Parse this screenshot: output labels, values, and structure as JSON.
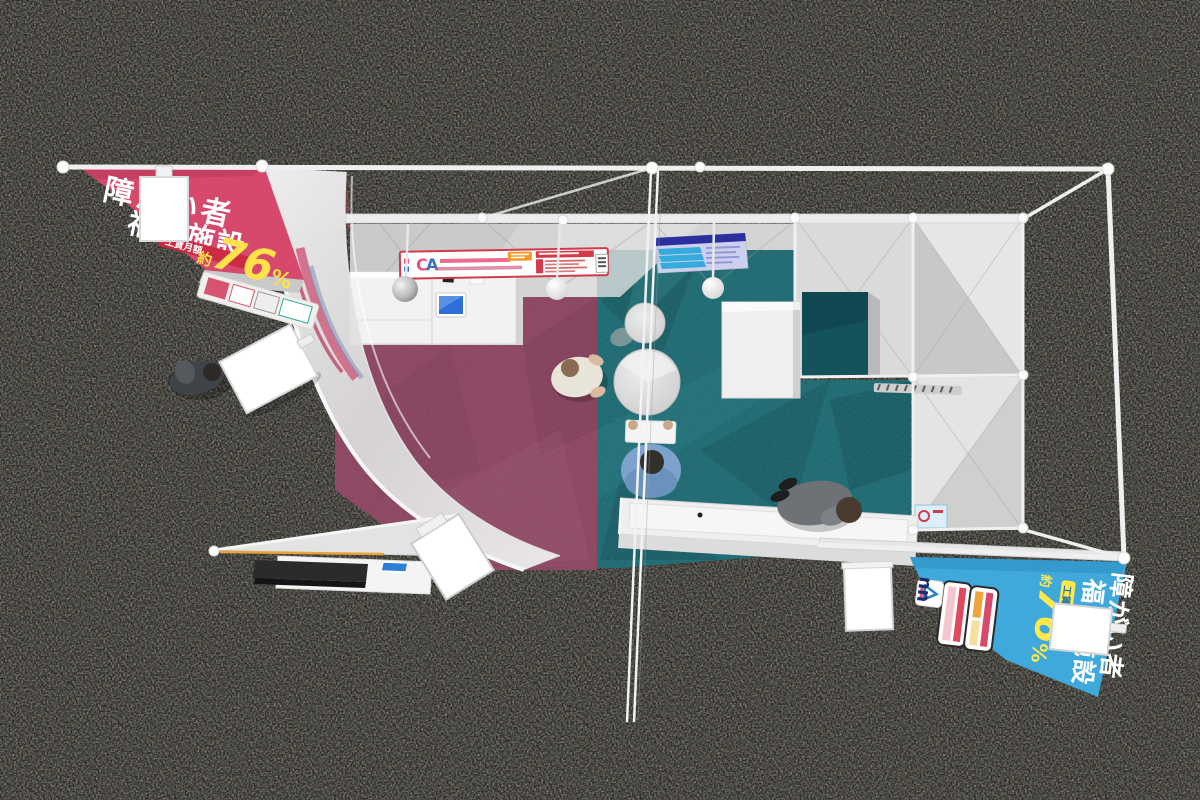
{
  "scene": {
    "setting": "exhibition booth 3D render, top-down view",
    "floor_color": "#2a2925",
    "frame_color": "#f0f0f0",
    "carpet_left_color": "#8e4663",
    "carpet_right_color": "#1d6b74",
    "inner_room_floor_color": "#14525c",
    "people_count": 4,
    "pendant_lamp_count": 3,
    "blank_sign_count": 5
  },
  "banner_left": {
    "line1": "障がい者",
    "line2": "福祉施設",
    "tag": "工賃月額",
    "approx": "約",
    "value": "76",
    "unit": "%",
    "bg": "#d6486c",
    "text_color": "#ffffff",
    "stat_color": "#ffe14a"
  },
  "banner_right": {
    "line1": "障がい者",
    "line2": "福祉施設",
    "tag": "工賃月額",
    "approx": "約",
    "value": "76",
    "unit": "%",
    "logo": "nn",
    "bg": "#3fa9dc",
    "text_color": "#ffffff",
    "stat_color": "#ffe94a"
  },
  "fascia_sign": {
    "logo_c": "C",
    "logo_a": "A",
    "bg": "#ffffff",
    "border": "#d03a4a"
  },
  "poster": {
    "header_color": "#2b2f9e",
    "stripe_color": "#35aadc",
    "bg": "#cdd0ec",
    "stripes": 3
  }
}
